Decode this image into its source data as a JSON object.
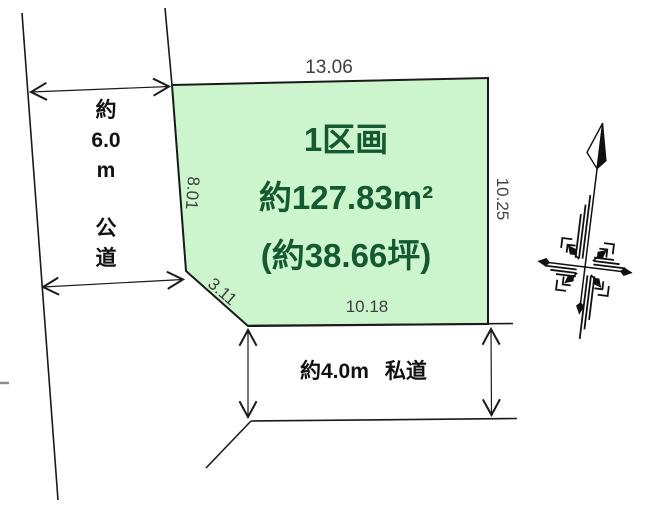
{
  "diagram": {
    "parcel": {
      "name_label": "1区画",
      "area_label": "約127.83m²",
      "tsubo_label": "(約38.66坪)",
      "fill_color": "#cdf5cd",
      "label_color": "#14592f"
    },
    "dimensions": {
      "top_edge": "13.06",
      "left_edge": "8.01",
      "right_edge": "10.25",
      "bottom_edge": "10.18",
      "corner_cut": "3.11",
      "label_color": "#3f3f3f"
    },
    "public_road": {
      "width_part1": "約",
      "width_part2": "6.0",
      "width_part3": "m",
      "type_part1": "公",
      "type_part2": "道"
    },
    "private_road": {
      "width_label": "約4.0m",
      "type_label": "私道"
    },
    "compass_icon": "north-compass-icon",
    "line_color": "#1a1a1a"
  }
}
